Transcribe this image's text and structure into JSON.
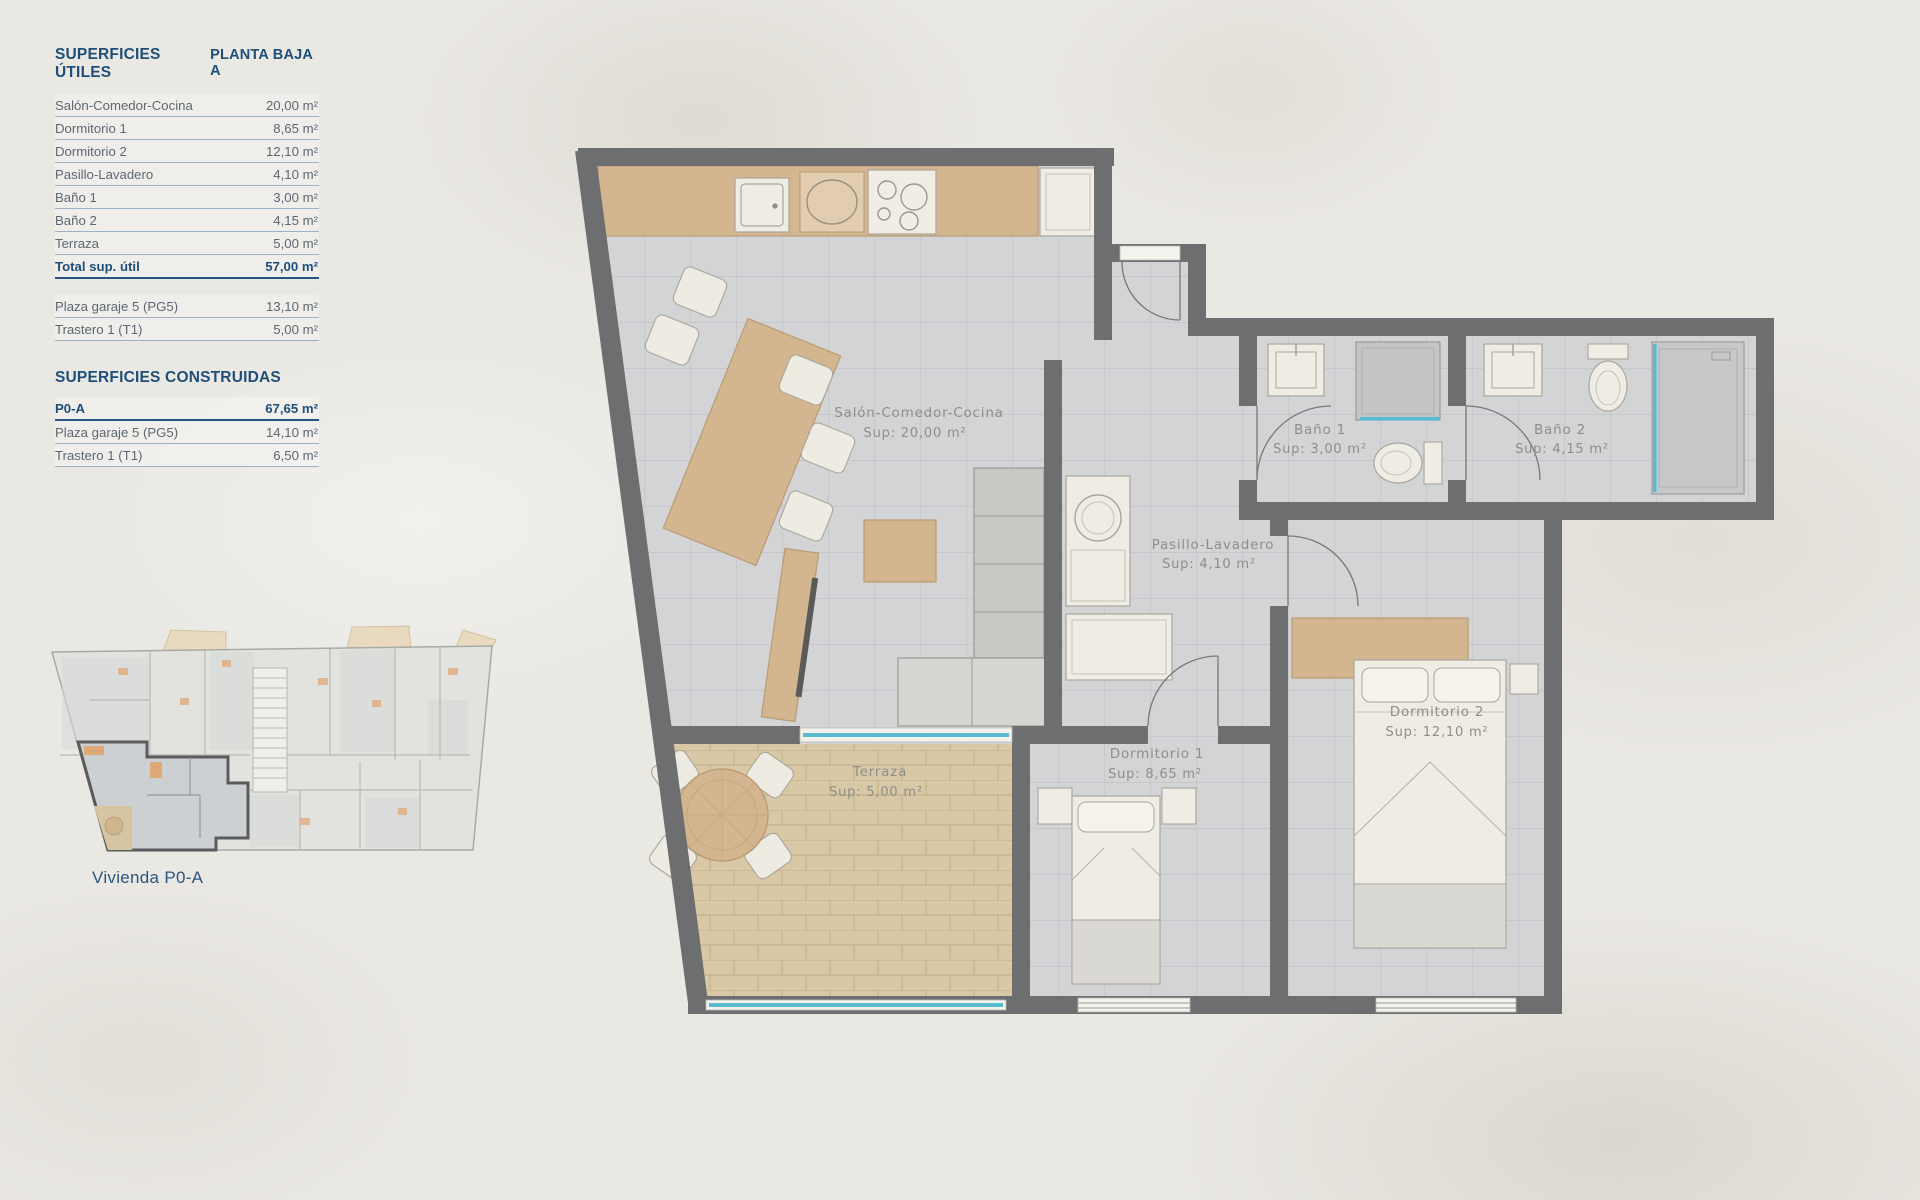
{
  "left_panel": {
    "utiles": {
      "title": "SUPERFICIES ÚTILES",
      "floor_label": "PLANTA BAJA A",
      "rows": [
        {
          "label": "Salón-Comedor-Cocina",
          "value": "20,00 m²"
        },
        {
          "label": "Dormitorio 1",
          "value": "8,65 m²"
        },
        {
          "label": "Dormitorio 2",
          "value": "12,10 m²"
        },
        {
          "label": "Pasillo-Lavadero",
          "value": "4,10 m²"
        },
        {
          "label": "Baño 1",
          "value": "3,00 m²"
        },
        {
          "label": "Baño 2",
          "value": "4,15 m²"
        },
        {
          "label": "Terraza",
          "value": "5,00 m²"
        }
      ],
      "total": {
        "label": "Total sup. útil",
        "value": "57,00 m²"
      },
      "annex_rows": [
        {
          "label": "Plaza garaje 5 (PG5)",
          "value": "13,10 m²"
        },
        {
          "label": "Trastero 1 (T1)",
          "value": "5,00 m²"
        }
      ]
    },
    "construidas": {
      "title": "SUPERFICIES CONSTRUIDAS",
      "rows": [
        {
          "label": "P0-A",
          "value": "67,65 m²"
        },
        {
          "label": "Plaza garaje 5 (PG5)",
          "value": "14,10 m²"
        },
        {
          "label": "Trastero 1 (T1)",
          "value": "6,50 m²"
        }
      ]
    },
    "mini_plan_caption": "Vivienda P0-A"
  },
  "plan": {
    "rooms": {
      "salon": {
        "name": "Salón-Comedor-Cocina",
        "sup": "Sup: 20,00 m²"
      },
      "bano1": {
        "name": "Baño 1",
        "sup": "Sup: 3,00 m²"
      },
      "bano2": {
        "name": "Baño 2",
        "sup": "Sup: 4,15 m²"
      },
      "pasillo": {
        "name": "Pasillo-Lavadero",
        "sup": "Sup: 4,10 m²"
      },
      "dorm1": {
        "name": "Dormitorio 1",
        "sup": "Sup: 8,65 m²"
      },
      "dorm2": {
        "name": "Dormitorio 2",
        "sup": "Sup: 12,10 m²"
      },
      "terraza": {
        "name": "Terraza",
        "sup": "Sup: 5,00 m²"
      }
    },
    "colors": {
      "wall": "#6d6e70",
      "tile": "#d3d4d6",
      "terrace": "#d9c8a6",
      "wood": "#d3b58f",
      "glass": "#57bcd0",
      "label": "#8e8e8b",
      "navy": "#27547e"
    }
  }
}
